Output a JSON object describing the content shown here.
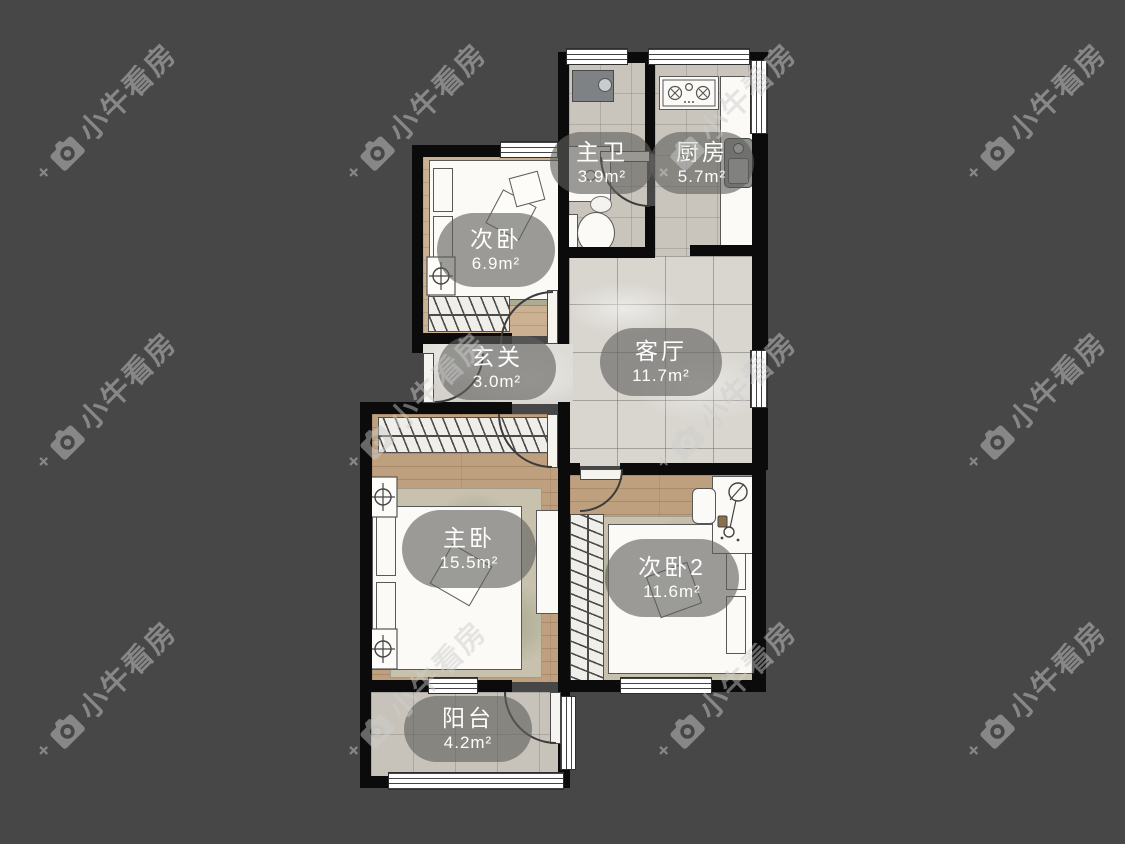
{
  "image": {
    "kind": "apartment-floorplan"
  },
  "background": {
    "color": "#474747",
    "wall_color": "#0b0b0b"
  },
  "watermark": {
    "text": "小牛看房",
    "color": "rgba(205,205,205,0.48)",
    "positions": [
      {
        "x": 105,
        "y": 112
      },
      {
        "x": 415,
        "y": 112
      },
      {
        "x": 725,
        "y": 112
      },
      {
        "x": 1035,
        "y": 112
      },
      {
        "x": 105,
        "y": 401
      },
      {
        "x": 415,
        "y": 401
      },
      {
        "x": 725,
        "y": 401
      },
      {
        "x": 1035,
        "y": 401
      },
      {
        "x": 105,
        "y": 690
      },
      {
        "x": 415,
        "y": 690
      },
      {
        "x": 725,
        "y": 690
      },
      {
        "x": 1035,
        "y": 690
      }
    ]
  },
  "floorplan": {
    "rooms": [
      {
        "id": "ciwo",
        "name": "次卧",
        "area": "6.9m²"
      },
      {
        "id": "zhuwei",
        "name": "主卫",
        "area": "3.9m²"
      },
      {
        "id": "chufang",
        "name": "厨房",
        "area": "5.7m²"
      },
      {
        "id": "xuanguan",
        "name": "玄关",
        "area": "3.0m²"
      },
      {
        "id": "keting",
        "name": "客厅",
        "area": "11.7m²"
      },
      {
        "id": "zhuwo",
        "name": "主卧",
        "area": "15.5m²"
      },
      {
        "id": "ciwo2",
        "name": "次卧2",
        "area": "11.6m²"
      },
      {
        "id": "yangtai",
        "name": "阳台",
        "area": "4.2m²"
      }
    ]
  }
}
